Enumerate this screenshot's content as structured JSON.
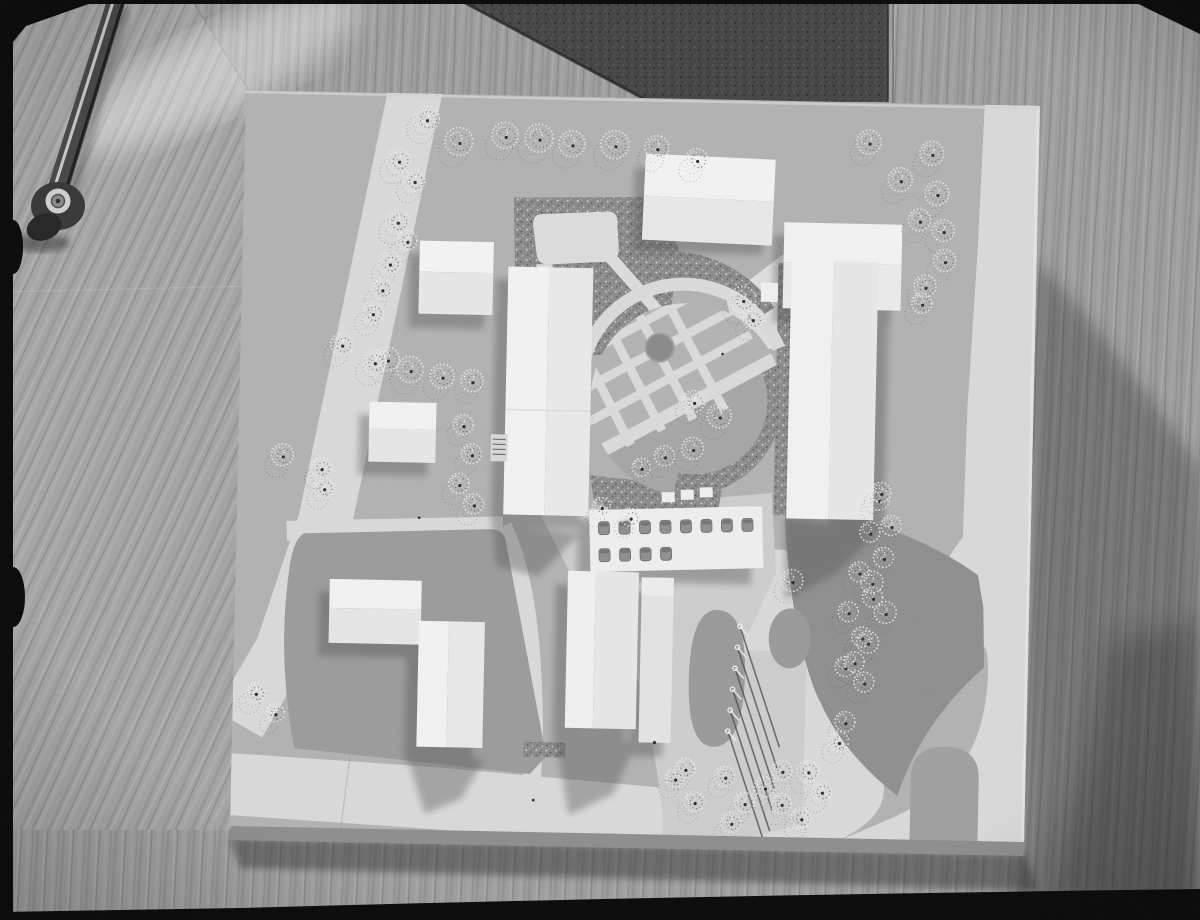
{
  "image": {
    "alt": "Black-and-white overhead photograph of a white architectural site model on a wooden table; a metal furniture leg with a caster wheel lies at the top left",
    "medium": "monochrome photograph",
    "palette": {
      "wood": "#9d9d9d",
      "wood_shadow": "#3c3c3c",
      "dark_mat": "#454545",
      "film_border": "#0a0a0a",
      "board_ground": "#b2b2b2",
      "road_white": "#d9d9d9",
      "building_white": "#f0f0f0",
      "lawn": "#9b9b9b",
      "lawn_dark": "#8f8f8f",
      "gravel": "#8a8a8a",
      "shadow": "#4f4f4f"
    }
  },
  "scene": {
    "model_board": {
      "building_count": 10,
      "central_garden": {
        "fountain_count": 1,
        "flower_bed_grid": true
      },
      "pond_count": 1,
      "skylight_hole_rows": [
        8,
        4
      ],
      "flagpole_count": 6,
      "tree_count": 78
    },
    "trees": [
      [
        179,
        23,
        13
      ],
      [
        212,
        45,
        14
      ],
      [
        258,
        38,
        13
      ],
      [
        292,
        40,
        14
      ],
      [
        325,
        45,
        13
      ],
      [
        368,
        45,
        14
      ],
      [
        410,
        47,
        12
      ],
      [
        450,
        58,
        11
      ],
      [
        152,
        65,
        12
      ],
      [
        168,
        85,
        11
      ],
      [
        152,
        126,
        12
      ],
      [
        162,
        145,
        10
      ],
      [
        145,
        168,
        11
      ],
      [
        138,
        194,
        10
      ],
      [
        129,
        218,
        11
      ],
      [
        145,
        264,
        12
      ],
      [
        99,
        250,
        11
      ],
      [
        132,
        267,
        12
      ],
      [
        168,
        274,
        13
      ],
      [
        200,
        280,
        12
      ],
      [
        230,
        284,
        11
      ],
      [
        222,
        328,
        10
      ],
      [
        231,
        357,
        10
      ],
      [
        219,
        387,
        10
      ],
      [
        234,
        407,
        10
      ],
      [
        42,
        362,
        11
      ],
      [
        81,
        374,
        10
      ],
      [
        84,
        394,
        10
      ],
      [
        20,
        600,
        10
      ],
      [
        40,
        620,
        9
      ],
      [
        499,
        197,
        13
      ],
      [
        509,
        216,
        10
      ],
      [
        452,
        300,
        11
      ],
      [
        478,
        314,
        12
      ],
      [
        452,
        347,
        11
      ],
      [
        424,
        355,
        10
      ],
      [
        401,
        367,
        9
      ],
      [
        362,
        407,
        9
      ],
      [
        391,
        417,
        9
      ],
      [
        622,
        37,
        12
      ],
      [
        654,
        74,
        12
      ],
      [
        685,
        47,
        12
      ],
      [
        691,
        87,
        12
      ],
      [
        674,
        114,
        11
      ],
      [
        698,
        124,
        11
      ],
      [
        700,
        154,
        11
      ],
      [
        681,
        180,
        11
      ],
      [
        678,
        197,
        10
      ],
      [
        639,
        394,
        11
      ],
      [
        652,
        420,
        10
      ],
      [
        641,
        387,
        10
      ],
      [
        631,
        427,
        10
      ],
      [
        645,
        452,
        10
      ],
      [
        621,
        467,
        10
      ],
      [
        635,
        492,
        10
      ],
      [
        611,
        507,
        10
      ],
      [
        625,
        532,
        10
      ],
      [
        609,
        562,
        10
      ],
      [
        554,
        477,
        11
      ],
      [
        634,
        477,
        11
      ],
      [
        648,
        507,
        11
      ],
      [
        631,
        537,
        11
      ],
      [
        618,
        557,
        10
      ],
      [
        628,
        577,
        10
      ],
      [
        610,
        617,
        10
      ],
      [
        604,
        637,
        10
      ],
      [
        574,
        667,
        11
      ],
      [
        588,
        687,
        10
      ],
      [
        548,
        667,
        10
      ],
      [
        531,
        684,
        10
      ],
      [
        511,
        700,
        10
      ],
      [
        491,
        674,
        10
      ],
      [
        451,
        667,
        10
      ],
      [
        441,
        677,
        9
      ],
      [
        461,
        700,
        10
      ],
      [
        498,
        720,
        10
      ],
      [
        548,
        700,
        10
      ],
      [
        568,
        714,
        10
      ]
    ],
    "flagpoles": {
      "tips": [
        [
          503,
          524
        ],
        [
          501,
          545
        ],
        [
          499,
          566
        ],
        [
          497,
          587
        ],
        [
          495,
          608
        ],
        [
          493,
          629
        ]
      ],
      "vector": [
        42,
        120
      ]
    }
  }
}
